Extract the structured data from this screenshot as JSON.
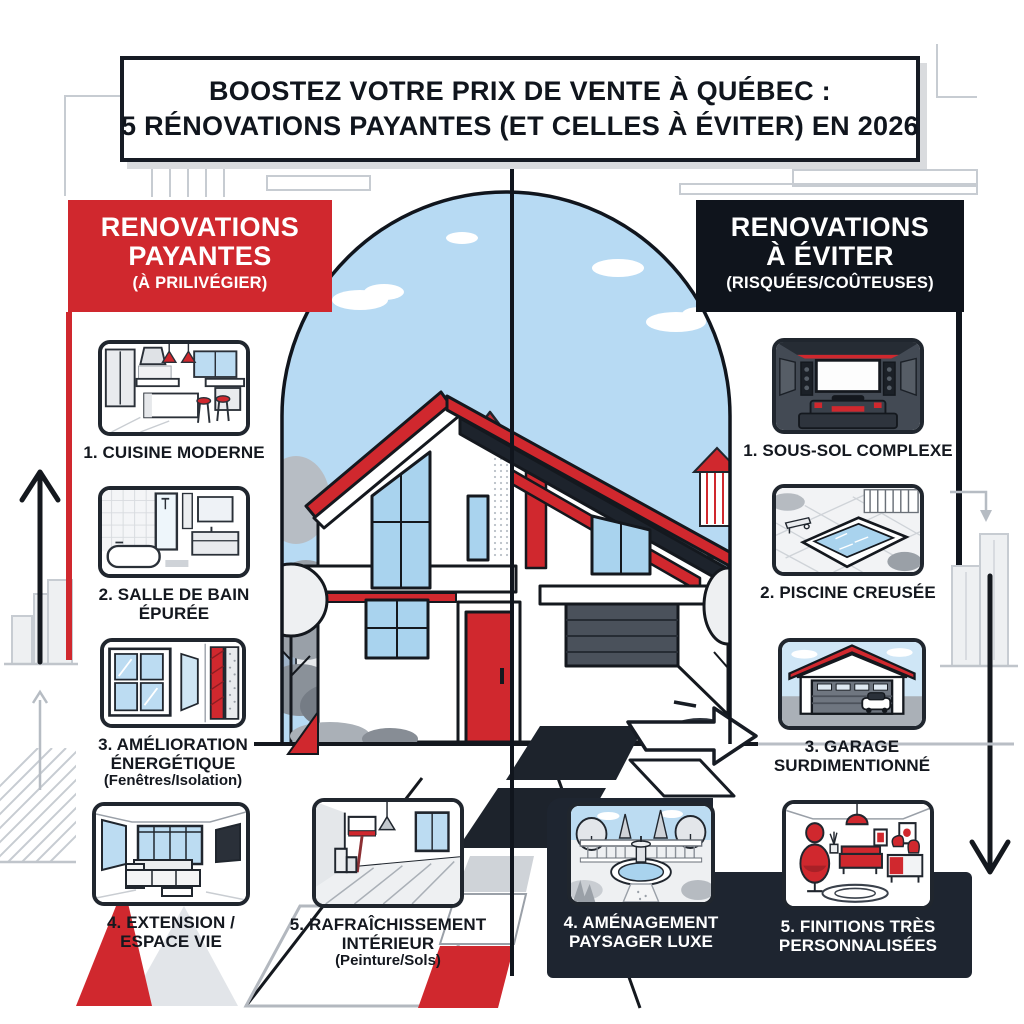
{
  "title": {
    "line1": "BOOSTEZ VOTRE PRIX DE VENTE À QUÉBEC :",
    "line2": "5 RÉNOVATIONS PAYANTES (ET CELLES À ÉVITER) EN 2026"
  },
  "left_column": {
    "header": {
      "line1": "RENOVATIONS",
      "line2": "PAYANTES",
      "subtitle": "(À PRILIVÉGIER)"
    },
    "items": [
      {
        "icon": "kitchen-illustration",
        "label": "1. CUISINE MODERNE"
      },
      {
        "icon": "bathroom-illustration",
        "label": "2. SALLE DE BAIN ÉPURÉE"
      },
      {
        "icon": "window-insulation-illustration",
        "label": "3. AMÉLIORATION ÉNERGÉTIQUE",
        "note": "(Fenêtres/Isolation)"
      },
      {
        "icon": "living-space-illustration",
        "label": "4. EXTENSION / ESPACE VIE"
      },
      {
        "icon": "interior-paint-illustration",
        "label": "5. RAFRAÎCHISSEMENT INTÉRIEUR",
        "note": "(Peinture/Sols)"
      }
    ]
  },
  "right_column": {
    "header": {
      "line1": "RENOVATIONS",
      "line2": "À ÉVITER",
      "subtitle": "(RISQUÉES/COÛTEUSES)"
    },
    "items": [
      {
        "icon": "home-theater-illustration",
        "label": "1. SOUS-SOL COMPLEXE"
      },
      {
        "icon": "pool-illustration",
        "label": "2. PISCINE CREUSÉE"
      },
      {
        "icon": "garage-illustration",
        "label": "3. GARAGE SURDIMENTIONNÉ"
      },
      {
        "icon": "landscaping-illustration",
        "label": "4. AMÉNAGEMENT PAYSAGER LUXE"
      },
      {
        "icon": "custom-finishes-illustration",
        "label": "5. FINITIONS TRÈS PERSONNALISÉES"
      }
    ]
  },
  "center_scene": {
    "illustration": "modern-house-split-view",
    "landmark": "chateau-frontenac-skyline"
  },
  "colors": {
    "accent_red": "#d0282e",
    "header_dark": "#0f141c",
    "panel_dark": "#1e2530",
    "sky_blue": "#b7daf3",
    "window_blue": "#a9d3ee",
    "line_gray": "#c7ccd2",
    "outline_dark": "#14181e"
  }
}
